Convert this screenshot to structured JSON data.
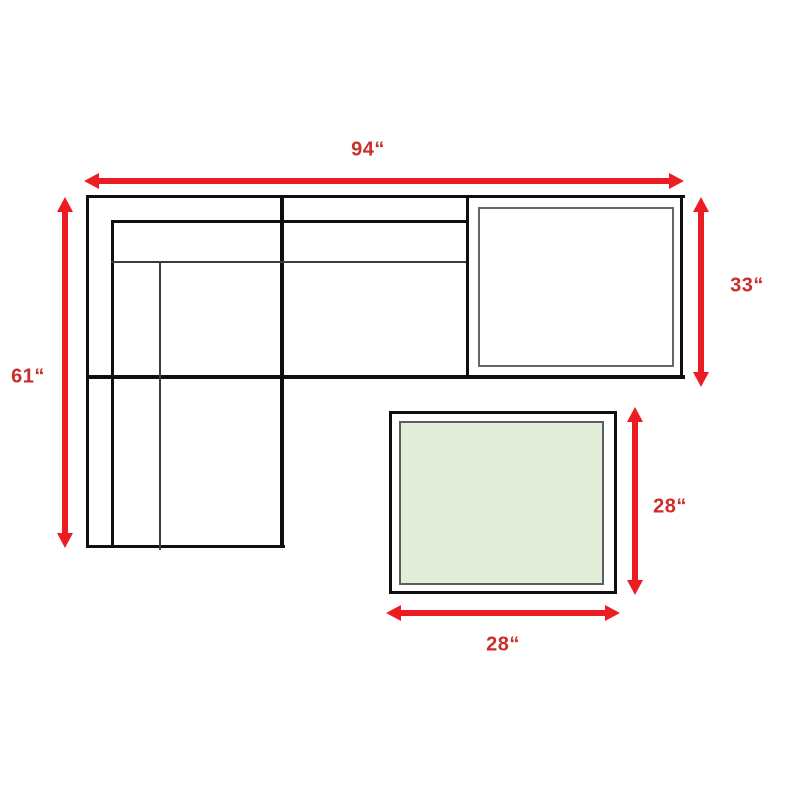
{
  "diagram": {
    "kind": "furniture-dimension-diagram",
    "pieces": [
      "sectional-sofa-with-chaise",
      "corner-section",
      "ottoman"
    ]
  },
  "dimensions": {
    "sofa_width": "94“",
    "sofa_depth": "61“",
    "corner_depth": "33“",
    "ottoman_depth": "28“",
    "ottoman_width": "28“"
  },
  "colors": {
    "arrow_red": "#ec1c23",
    "label_red": "#cb2d2a",
    "outline_black": "#0e0e0e",
    "inner_line_gray": "#666666",
    "ottoman_fill_green": "#e2eeda",
    "background": "#ffffff"
  }
}
